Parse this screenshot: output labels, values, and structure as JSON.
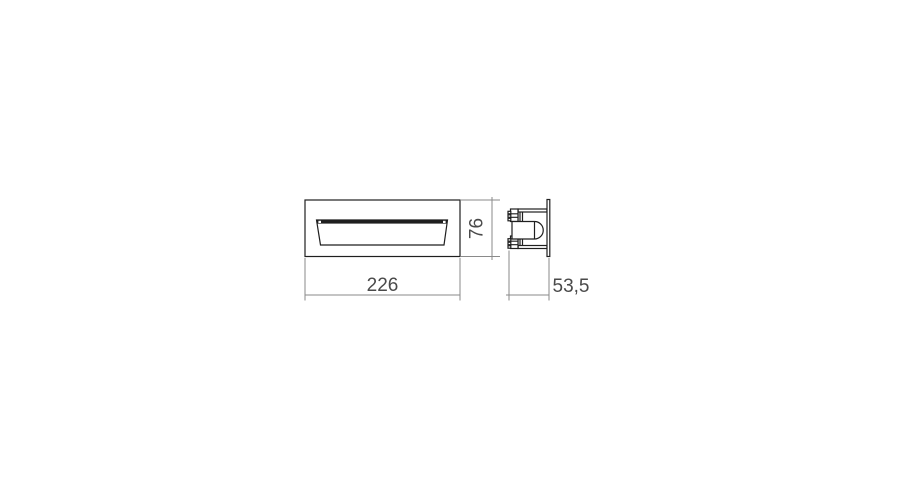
{
  "canvas": {
    "width": 900,
    "height": 500,
    "background": "#ffffff"
  },
  "drawing": {
    "type": "technical-dimension-drawing",
    "views": [
      "front-view",
      "side-view"
    ],
    "dimensions": {
      "width": {
        "value": "226"
      },
      "height": {
        "value": "76"
      },
      "depth": {
        "value": "53,5"
      }
    },
    "colors": {
      "object_line": "#1f1f1f",
      "dimension_line": "#8a8a8a",
      "dimension_text": "#4a4a4a",
      "background": "#ffffff"
    }
  }
}
